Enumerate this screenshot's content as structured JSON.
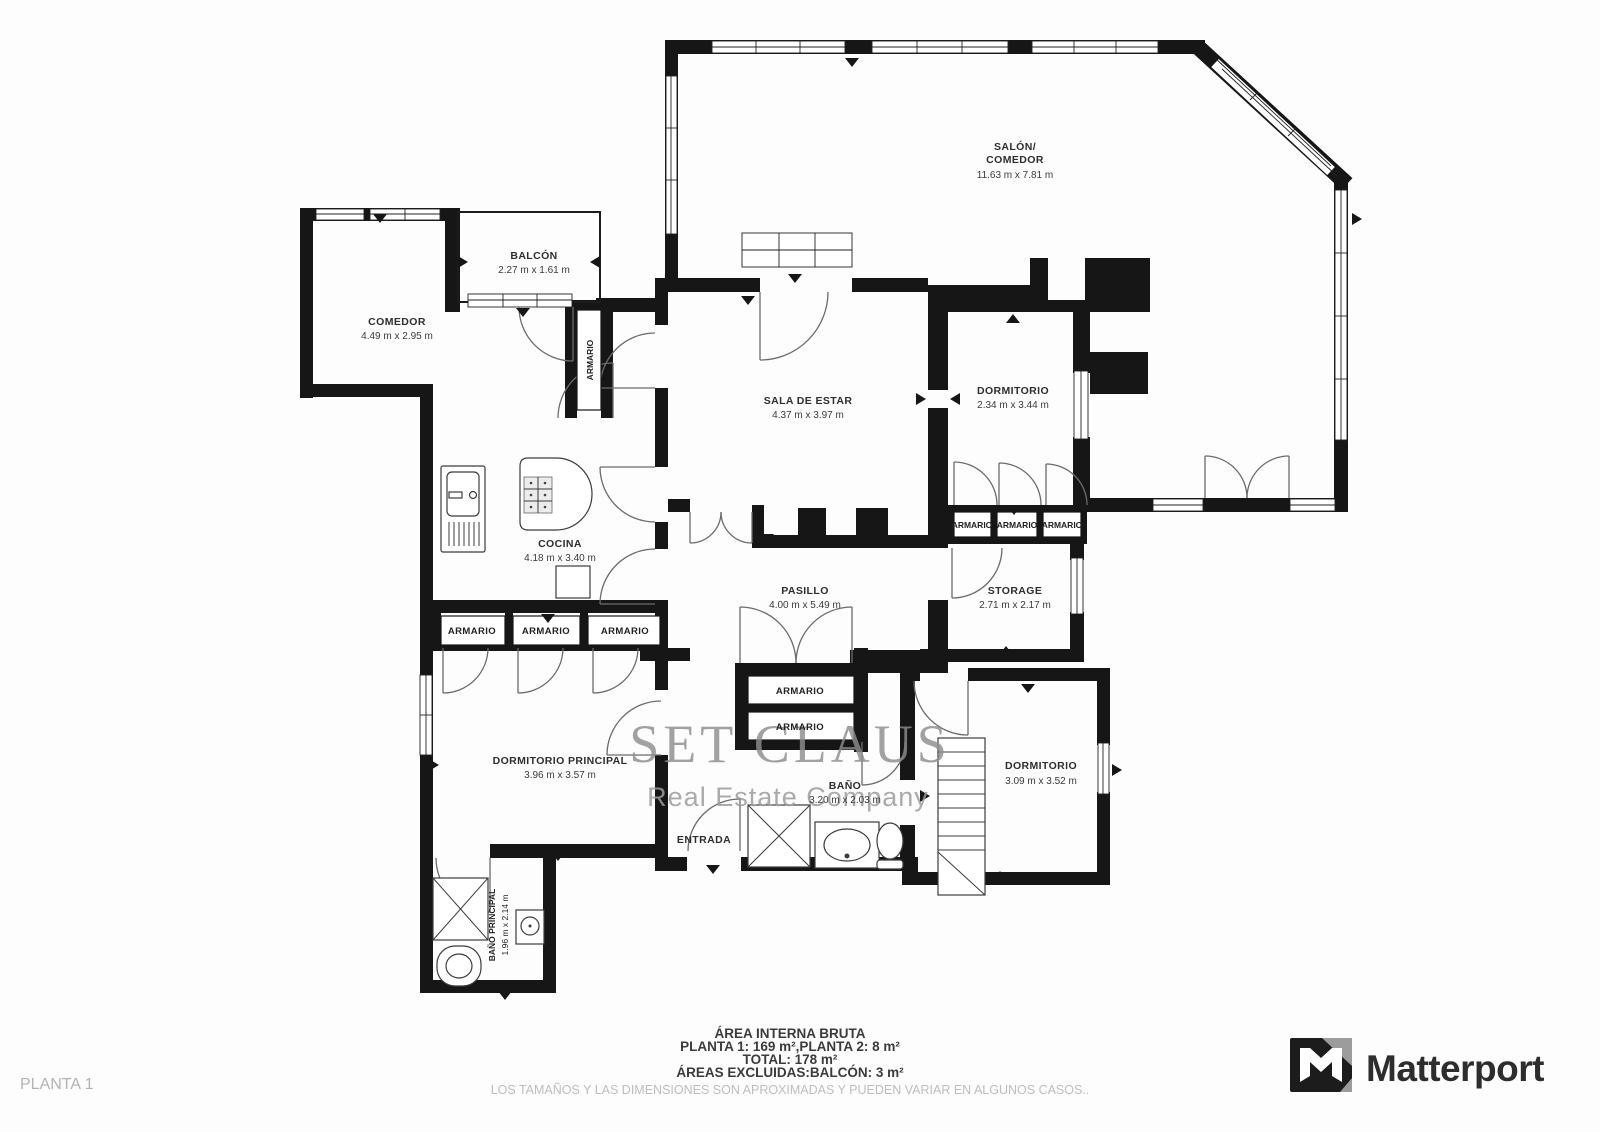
{
  "page": {
    "plan_label": "PLANTA 1"
  },
  "colors": {
    "walls": "#161616",
    "watermark": "#8d8d8d",
    "disclaimer": "#bdbdbd"
  },
  "watermark": {
    "title": "SET CLAUS",
    "subtitle": "Real Estate Company"
  },
  "labels": {
    "armario": "ARMARIO"
  },
  "rooms": {
    "salon": {
      "name_line1": "SALÓN/",
      "name_line2": "COMEDOR",
      "dims": "11.63 m x 7.81 m"
    },
    "balcon": {
      "name": "BALCÓN",
      "dims": "2.27 m x 1.61 m"
    },
    "comedor": {
      "name": "COMEDOR",
      "dims": "4.49 m x 2.95 m"
    },
    "sala_de_estar": {
      "name": "SALA DE ESTAR",
      "dims": "4.37 m x 3.97 m"
    },
    "dormitorio_1": {
      "name": "DORMITORIO",
      "dims": "2.34 m x 3.44 m"
    },
    "cocina": {
      "name": "COCINA",
      "dims": "4.18 m x 3.40 m"
    },
    "pasillo": {
      "name": "PASILLO",
      "dims": "4.00 m x 5.49 m"
    },
    "storage": {
      "name": "STORAGE",
      "dims": "2.71 m x 2.17 m"
    },
    "dormitorio_principal": {
      "name": "DORMITORIO PRINCIPAL",
      "dims": "3.96 m x 3.57 m"
    },
    "bano": {
      "name": "BAÑO",
      "dims": "3.20 m x 2.03 m"
    },
    "dormitorio_2": {
      "name": "DORMITORIO",
      "dims": "3.09 m x 3.52 m"
    },
    "entrada": {
      "name": "ENTRADA"
    },
    "bano_principal": {
      "name": "BAÑO PRINCIPAL",
      "dims": "1.96 m x 2.14 m"
    }
  },
  "footer": {
    "area_title": "ÁREA INTERNA BRUTA",
    "planta_line": "PLANTA 1: 169 m²,PLANTA 2: 8 m²",
    "total_line": "TOTAL: 178 m²",
    "excluded_line": "ÁREAS EXCLUIDAS:BALCÓN: 3 m²",
    "disclaimer": "LOS TAMAÑOS Y LAS DIMENSIONES SON APROXIMADAS Y PUEDEN VARIAR EN ALGUNOS CASOS.."
  },
  "branding": {
    "logo_text": "Matterport"
  }
}
